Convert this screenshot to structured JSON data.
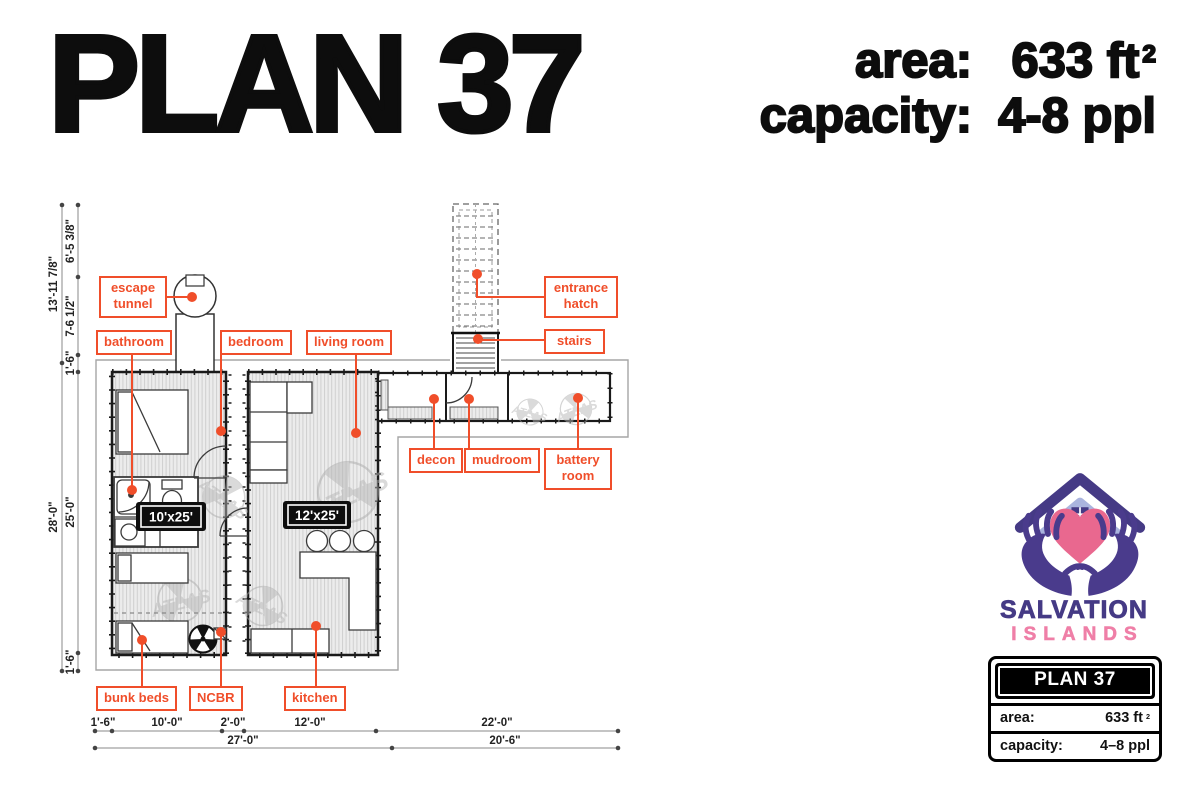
{
  "header": {
    "title": "PLAN 37",
    "stats": [
      {
        "label": "area:",
        "value": "633 ft",
        "sup": "2"
      },
      {
        "label": "capacity:",
        "value": "4-8 ppl",
        "sup": ""
      }
    ]
  },
  "plan": {
    "labels": [
      {
        "id": "escape-tunnel",
        "text": "escape tunnel"
      },
      {
        "id": "bathroom",
        "text": "bathroom"
      },
      {
        "id": "bedroom",
        "text": "bedroom"
      },
      {
        "id": "living-room",
        "text": "living room"
      },
      {
        "id": "entrance-hatch",
        "text": "entrance hatch"
      },
      {
        "id": "stairs",
        "text": "stairs"
      },
      {
        "id": "decon",
        "text": "decon"
      },
      {
        "id": "mudroom",
        "text": "mudroom"
      },
      {
        "id": "battery-room",
        "text": "battery room"
      },
      {
        "id": "bunk-beds",
        "text": "bunk beds"
      },
      {
        "id": "ncbr",
        "text": "NCBR"
      },
      {
        "id": "kitchen",
        "text": "kitchen"
      }
    ],
    "badges": [
      {
        "text": "10'x25'"
      },
      {
        "text": "12'x25'"
      }
    ],
    "dims": {
      "left_outer": [
        {
          "text": "13'-11 7/8\""
        },
        {
          "text": "28'-0\""
        }
      ],
      "left_inner": [
        {
          "text": "6'-5 3/8\""
        },
        {
          "text": "7-6 1/2\""
        },
        {
          "text": "1'-6\""
        },
        {
          "text": "25'-0\""
        },
        {
          "text": "1'-6\""
        }
      ],
      "bottom_row1": [
        {
          "text": "1'-6\""
        },
        {
          "text": "10'-0\""
        },
        {
          "text": "2'-0\""
        },
        {
          "text": "12'-0\""
        },
        {
          "text": "22'-0\""
        }
      ],
      "bottom_row2": [
        {
          "text": "27'-0\""
        },
        {
          "text": "20'-6\""
        }
      ]
    },
    "watermark": "ATLAS"
  },
  "branding": {
    "name_line1": "SALVATION",
    "name_line2": "ISLANDS",
    "card": {
      "title": "PLAN 37",
      "rows": [
        {
          "label": "area:",
          "value": "633 ft",
          "sup": "2"
        },
        {
          "label": "capacity:",
          "value": "4–8 ppl",
          "sup": ""
        }
      ]
    }
  },
  "colors": {
    "accent": "#f04e2a",
    "brand_purple": "#453a85",
    "brand_pink": "#ef7fa7",
    "heart_pink": "#e9688f",
    "roof_light": "#aab4de"
  }
}
